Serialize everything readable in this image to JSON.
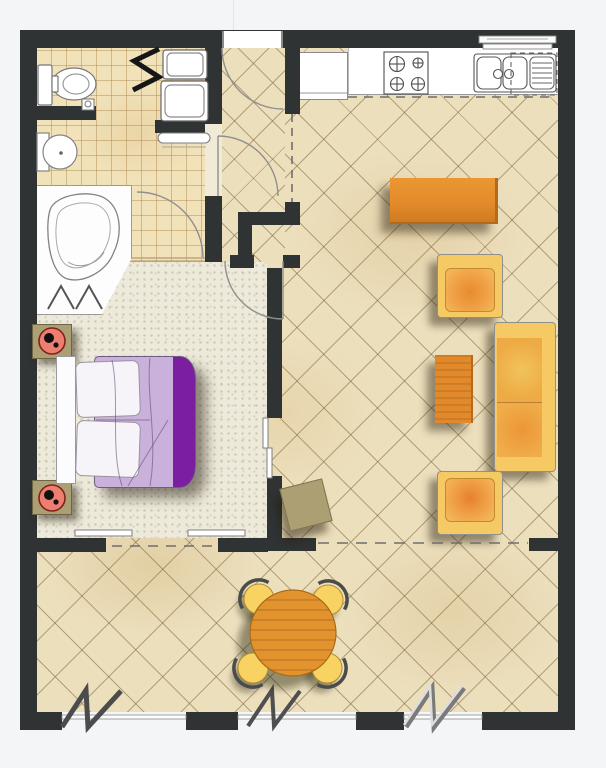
{
  "diagram": {
    "kind": "apartment-floor-plan",
    "visible_text": [],
    "rooms": [
      "bathroom",
      "entry-hall",
      "kitchen",
      "living-room",
      "bedroom",
      "patio-terrace"
    ],
    "furniture_symbols": [
      "toilet",
      "pedestal-basin",
      "corner-bathtub",
      "washer-dryer-stack",
      "towel-rail",
      "radiator-zigzag",
      "fridge",
      "four-burner-stove",
      "double-sink-with-drainer",
      "dishwasher-dashed",
      "wall-shelf",
      "sideboard",
      "armchair",
      "armchair",
      "sofa",
      "coffee-table",
      "cube-stool",
      "double-bed",
      "nightstand-with-lamp",
      "nightstand-with-lamp",
      "round-dining-table",
      "dining-chair",
      "dining-chair",
      "dining-chair",
      "dining-chair"
    ],
    "architecture_symbols": [
      "door-swing-arc-entry",
      "door-swing-arc-bathroom",
      "door-swing-arc-bedroom",
      "door-swing-arc-bath-inner",
      "window-zigzag-left",
      "window-zigzag-center",
      "window-zigzag-right",
      "sliding-door-panels",
      "open-threshold-dashed-lines"
    ]
  },
  "palette": {
    "page_bg": "#f4f5f7",
    "wall": "#303334",
    "floor_tile": "#ecdfbc",
    "bathroom_tile": "#f2e2ba",
    "bedroom_floor": "#edeadb",
    "counter_white": "#ffffff",
    "furniture_orange": "#e28a2b",
    "cushion_yellow": "#f5c964",
    "chair_yellow": "#f8d363",
    "duvet_lavender": "#c9b1dc",
    "duvet_purple": "#7b1fa0",
    "nightstand_khaki": "#ab9f73",
    "lamp_red": "#ee7e6f",
    "fixture_line": "#8a8a8a"
  }
}
